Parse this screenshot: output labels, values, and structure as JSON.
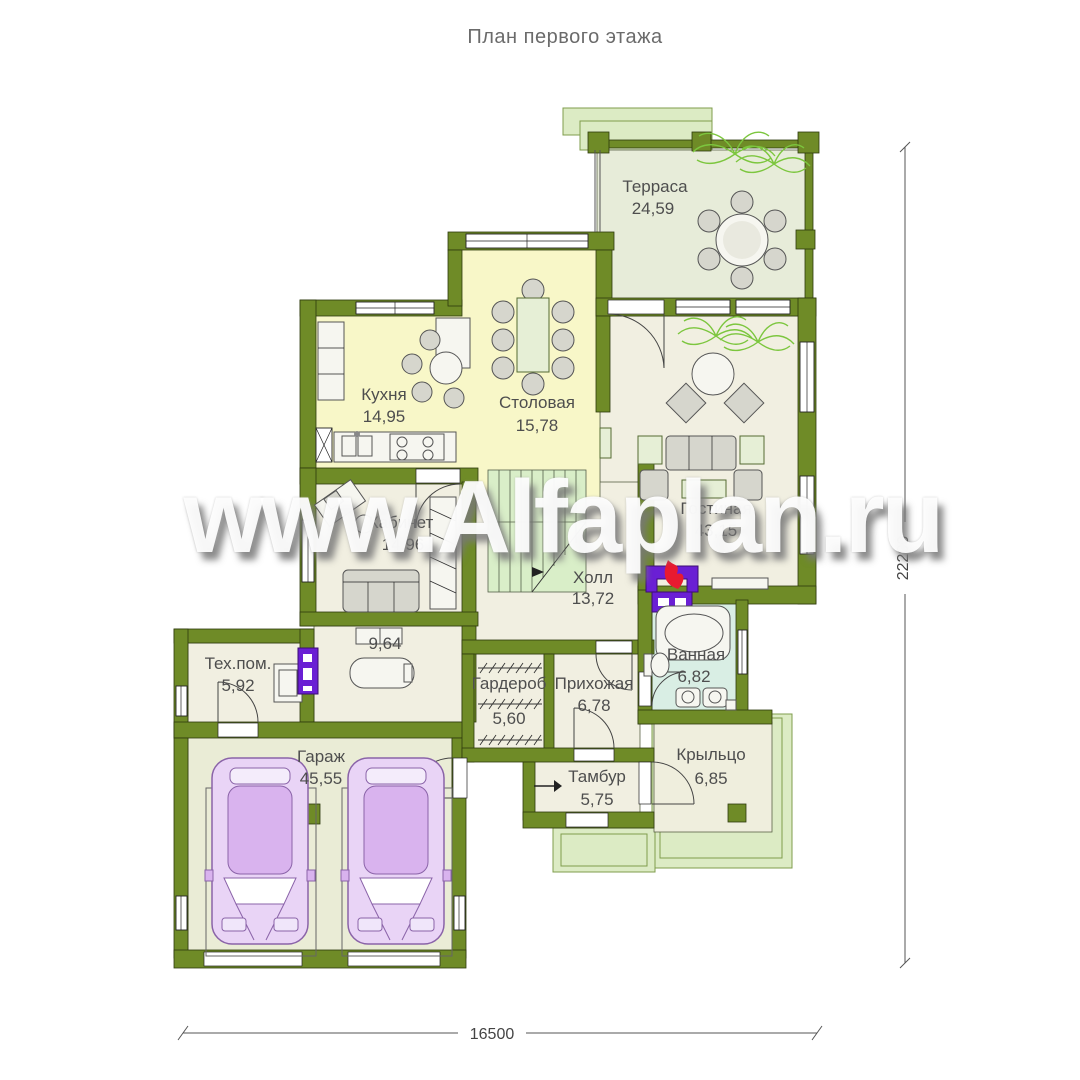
{
  "title": "План первого этажа",
  "watermark": "www.Alfaplan.ru",
  "rooms": {
    "terrace": {
      "name": "Терраса",
      "area": "24,59"
    },
    "kitchen": {
      "name": "Кухня",
      "area": "14,95"
    },
    "dining": {
      "name": "Столовая",
      "area": "15,78"
    },
    "living": {
      "name": "Гостиная",
      "area": "43,15"
    },
    "study": {
      "name": "Кабинет",
      "area": "14,96"
    },
    "hall": {
      "name": "Холл",
      "area": "13,72"
    },
    "sauna": {
      "name": "",
      "area": "9,64"
    },
    "tech": {
      "name": "Тех.пом.",
      "area": "5,92"
    },
    "wardrobe": {
      "name": "Гардероб",
      "area": "5,60"
    },
    "entry": {
      "name": "Прихожая",
      "area": "6,78"
    },
    "bathroom": {
      "name": "Ванная",
      "area": "6,82"
    },
    "tambour": {
      "name": "Тамбур",
      "area": "5,75"
    },
    "porch": {
      "name": "Крыльцо",
      "area": "6,85"
    },
    "garage": {
      "name": "Гараж",
      "area": "45,55"
    }
  },
  "dimensions": {
    "width": "16500",
    "height": "22200"
  },
  "colors": {
    "wall": "#6f8b27",
    "floor_cream": "#f1efe1",
    "floor_yellow": "#f8f7c8",
    "floor_terrace": "#e7ecd9",
    "floor_bath": "#d9eee4",
    "floor_garage": "#eaecd6",
    "floor_porch": "#efeedd",
    "steps_green": "#dcebc4",
    "stairs_green": "#d9eec8",
    "car_body": "#e9d4f6",
    "car_roof": "#d9b3ee",
    "fireplace_purple": "#6a1fd4",
    "flame_red": "#e81a30",
    "plant_green": "#7cc63e"
  }
}
